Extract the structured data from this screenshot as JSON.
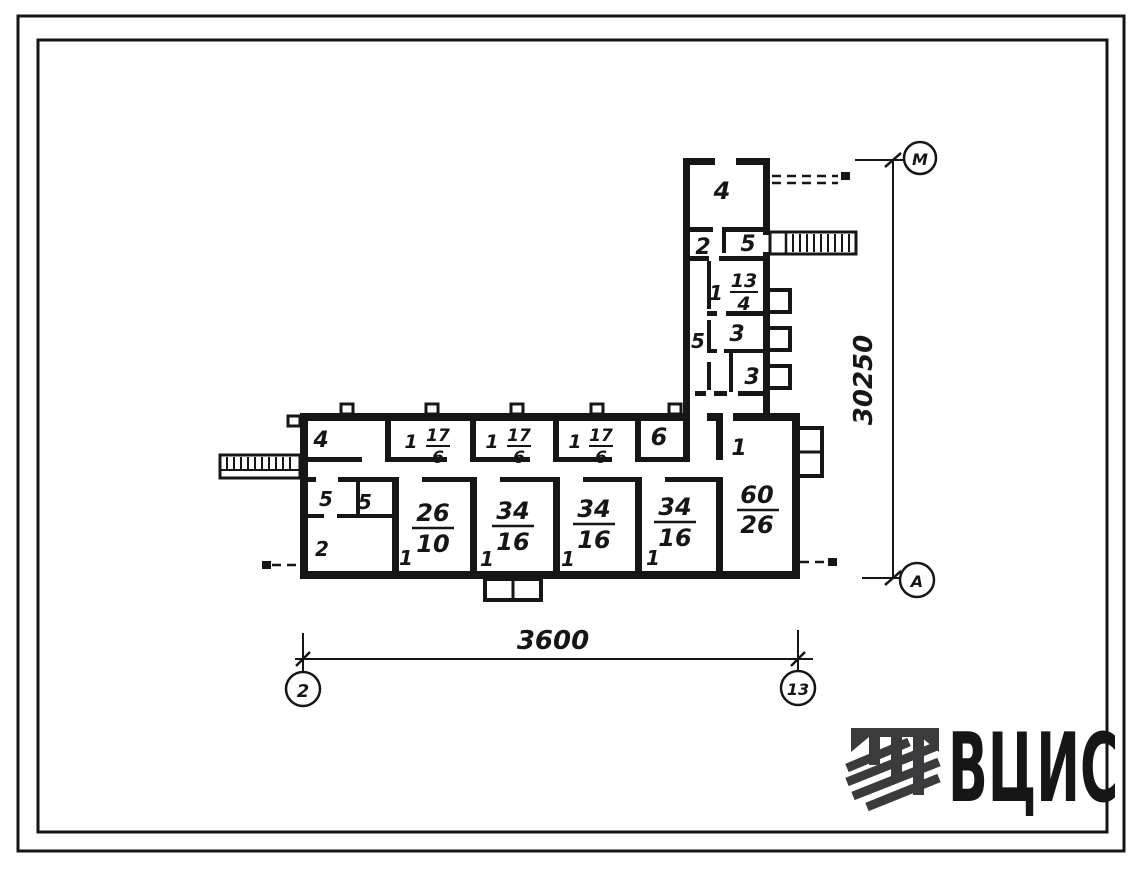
{
  "page": {
    "background": "#ffffff",
    "frame_color": "#151515",
    "ink_color": "#161616"
  },
  "plan": {
    "upper_wing": {
      "room4": {
        "label": "4"
      },
      "room2": {
        "label": "2"
      },
      "room5": {
        "label": "5"
      },
      "room1": {
        "label": "1",
        "area": {
          "num": "13",
          "den": "4"
        }
      },
      "corridor5": {
        "label": "5"
      },
      "room3a": {
        "label": "3"
      },
      "room3b": {
        "label": "3"
      }
    },
    "top_row": {
      "room4": {
        "label": "4"
      },
      "r1": {
        "label": "1",
        "area": {
          "num": "17",
          "den": "6"
        }
      },
      "r2": {
        "label": "1",
        "area": {
          "num": "17",
          "den": "6"
        }
      },
      "r3": {
        "label": "1",
        "area": {
          "num": "17",
          "den": "6"
        }
      },
      "room6": {
        "label": "6"
      },
      "big_room": {
        "label": "1",
        "area": {
          "num": "60",
          "den": "26"
        }
      }
    },
    "bottom_row": {
      "r5a": {
        "label": "5"
      },
      "r5b": {
        "label": "5"
      },
      "room2": {
        "label": "2"
      },
      "r26": {
        "label": "1",
        "area": {
          "num": "26",
          "den": "10"
        }
      },
      "r34a": {
        "label": "1",
        "area": {
          "num": "34",
          "den": "16"
        }
      },
      "r34b": {
        "label": "1",
        "area": {
          "num": "34",
          "den": "16"
        }
      },
      "r34c": {
        "label": "1",
        "area": {
          "num": "34",
          "den": "16"
        }
      }
    }
  },
  "dimensions": {
    "bottom": {
      "value": "3600",
      "left_axis": "2",
      "right_axis": "13"
    },
    "right": {
      "value": "30250",
      "top_axis": "М",
      "bottom_axis": "А"
    }
  },
  "logo": {
    "text": "ВЦИС",
    "color": "#3b3b3e"
  }
}
